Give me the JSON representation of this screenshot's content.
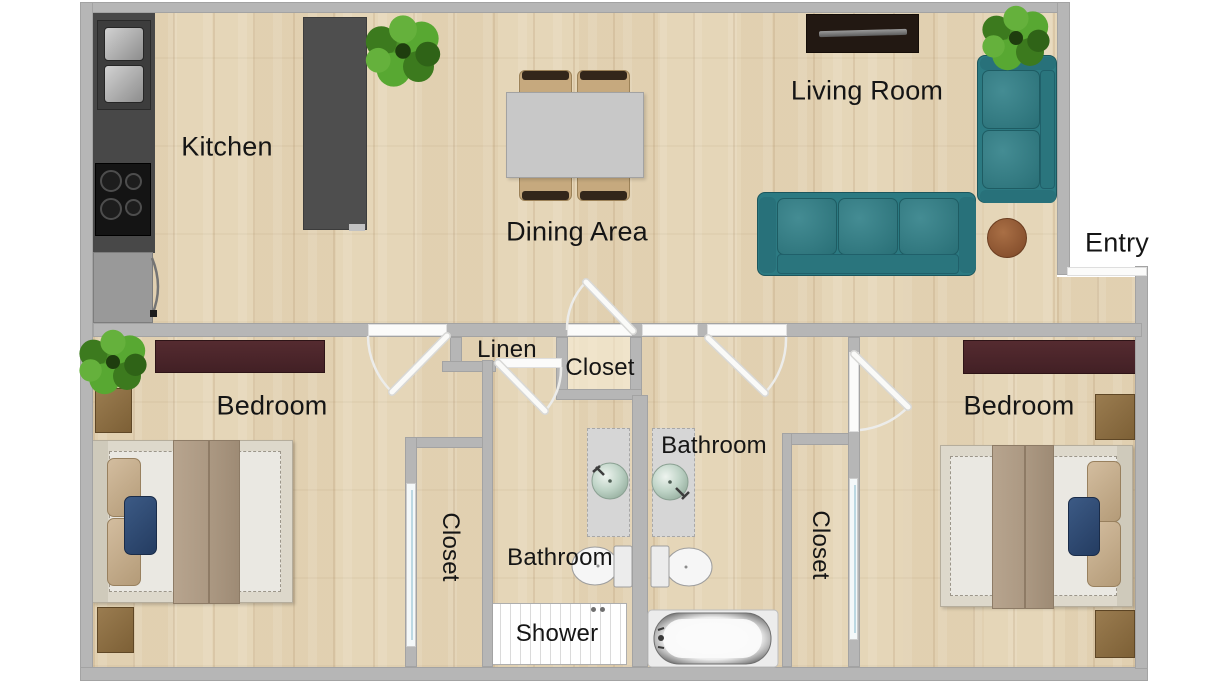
{
  "rooms": {
    "kitchen": {
      "label": "Kitchen"
    },
    "dining_area": {
      "label": "Dining Area"
    },
    "living_room": {
      "label": "Living Room"
    },
    "entry": {
      "label": "Entry"
    },
    "bedroom_left": {
      "label": "Bedroom"
    },
    "bedroom_right": {
      "label": "Bedroom"
    },
    "linen_closet": {
      "label": "Linen"
    },
    "hall_closet": {
      "label": "Closet"
    },
    "closet_left": {
      "label": "Closet"
    },
    "closet_right": {
      "label": "Closet"
    },
    "bathroom_left": {
      "label": "Bathroom"
    },
    "bathroom_right": {
      "label": "Bathroom"
    },
    "shower": {
      "label": "Shower"
    }
  },
  "palette": {
    "floor_wood": "#e5d6b8",
    "wall_gray": "#b6b6b6",
    "sofa_teal": "#2c7a82",
    "counter_dark": "#484848",
    "dresser_maroon": "#4b262b",
    "dining_table_gray": "#c8c8c8",
    "coffee_table_brown": "#8a6847",
    "accent_pillow_navy": "#2e4a72",
    "sink_mint": "#b7cec1",
    "plant_green": "#55a02c",
    "door_white": "#fbfbfa"
  },
  "furniture_icons": [
    "kitchen-sink",
    "cooktop",
    "refrigerator",
    "kitchen-island",
    "dining-table",
    "dining-chair",
    "tv-console",
    "sofa",
    "loveseat",
    "coffee-table",
    "side-table",
    "potted-plant",
    "dresser",
    "nightstand",
    "double-bed",
    "bathroom-vanity",
    "vessel-sink",
    "toilet",
    "bathtub",
    "shower-stall",
    "sliding-closet-door",
    "interior-door"
  ]
}
